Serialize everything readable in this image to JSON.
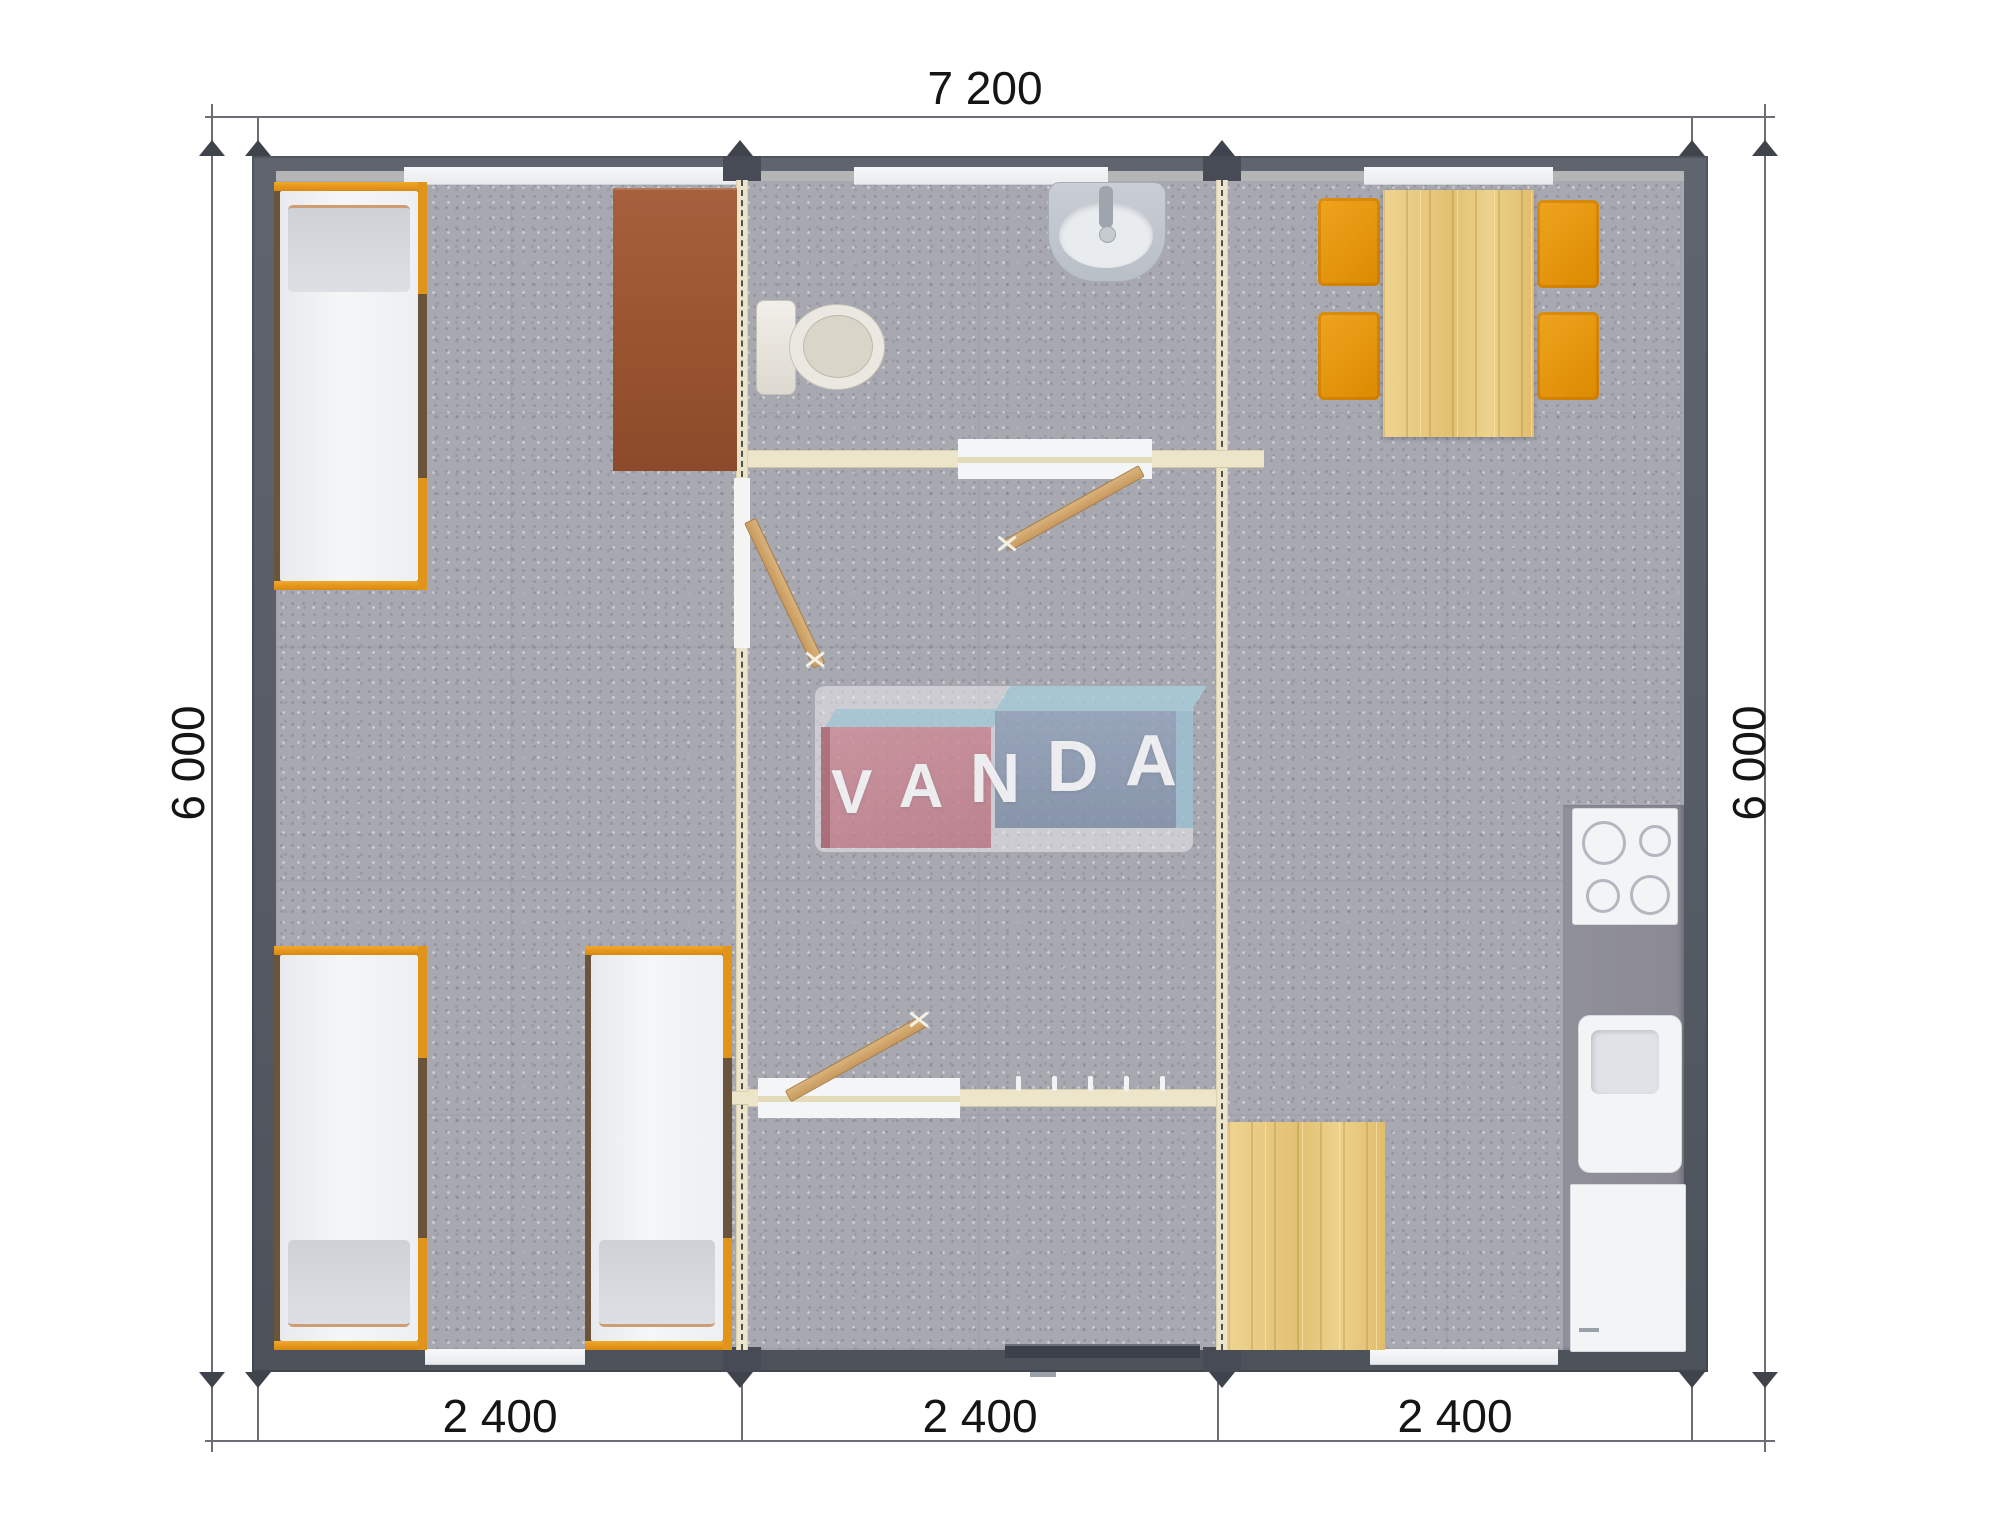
{
  "plan": {
    "logo": {
      "text": "VANDA",
      "letters": [
        "V",
        "A",
        "N",
        "D",
        "A"
      ]
    },
    "dimensions": {
      "top_width": "7 200",
      "left_height": "6 000",
      "right_height": "6 000",
      "bottom_modules": [
        "2 400",
        "2 400",
        "2 400"
      ]
    },
    "modules": [
      {
        "name": "bedroom-module",
        "width_label": "2 400",
        "furniture": [
          "single-bed",
          "single-bed",
          "single-bed",
          "desk"
        ]
      },
      {
        "name": "entrance-bathroom-module",
        "width_label": "2 400",
        "furniture": [
          "toilet",
          "wash-basin",
          "interior-door",
          "interior-door",
          "interior-door",
          "entrance-door",
          "coat-hooks"
        ]
      },
      {
        "name": "kitchen-dining-module",
        "width_label": "2 400",
        "furniture": [
          "dining-table",
          "chair",
          "chair",
          "chair",
          "chair",
          "cooktop",
          "kitchen-sink",
          "base-cabinet",
          "wood-floor-mat"
        ]
      }
    ],
    "colors": {
      "wall": "#565a64",
      "floor": "#a8a8b1",
      "module_joint": "#ece5c9",
      "bed_frame_orange": "#e1941a",
      "chair_orange": "#e39200",
      "light_wood": "#e9cd86",
      "desk_brown": "#9c5838",
      "kitchen_counter": "#8e8d96",
      "logo_red": "#c98995",
      "logo_blue": "#8b9cb4",
      "logo_cyan": "#a9cdd9"
    }
  }
}
